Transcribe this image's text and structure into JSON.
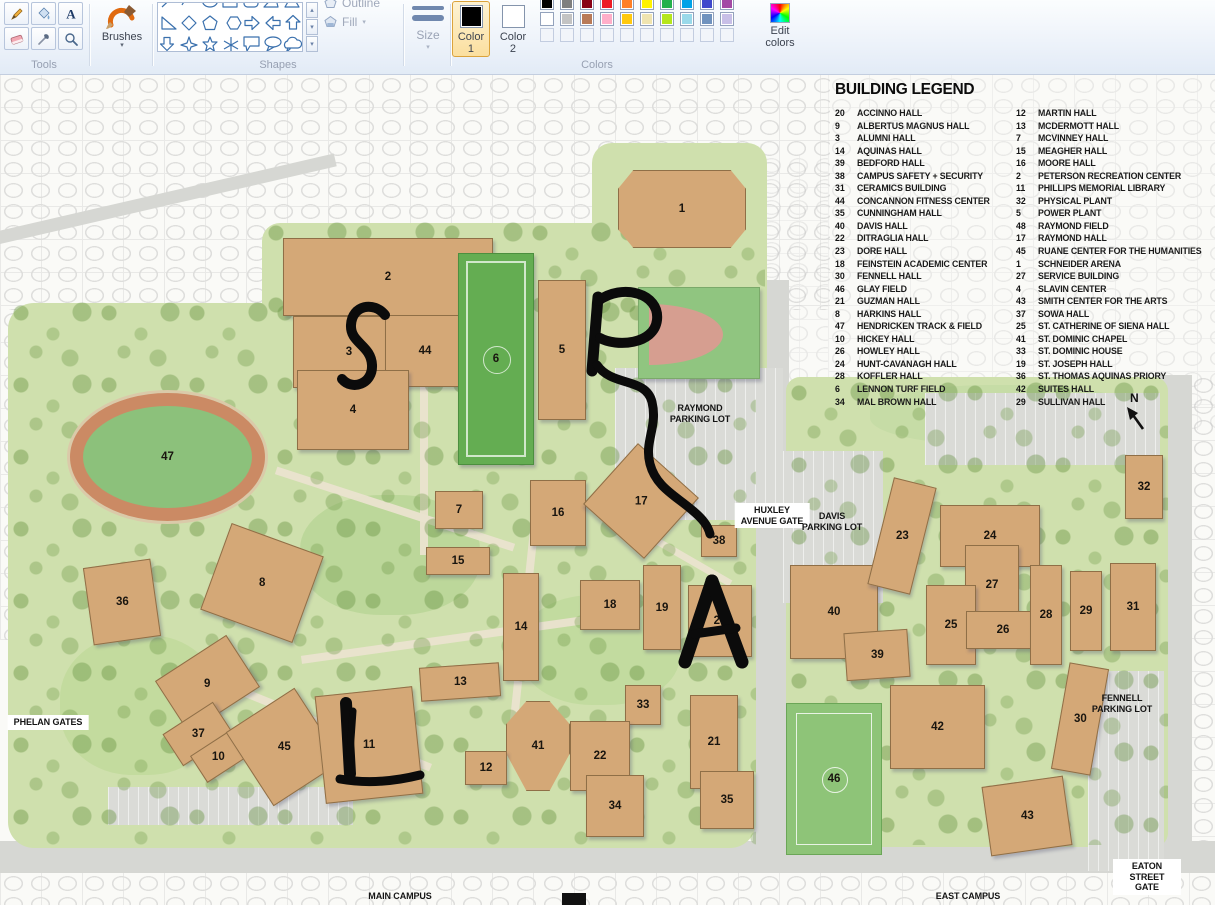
{
  "ribbon": {
    "tools": {
      "label": "Tools",
      "items": [
        "pencil",
        "fill-with-color",
        "text",
        "eraser",
        "color-picker",
        "magnifier"
      ]
    },
    "brushes": {
      "label": "Brushes",
      "arrow": "▾"
    },
    "shapes": {
      "label": "Shapes",
      "outline_label": "Outline",
      "fill_label": "Fill",
      "fill_arrow": "▾"
    },
    "size": {
      "label": "Size",
      "arrow": "▾"
    },
    "colors": {
      "label": "Colors",
      "color1": {
        "label_1": "Color",
        "label_2": "1",
        "value": "#000000"
      },
      "color2": {
        "label_1": "Color",
        "label_2": "2",
        "value": "#ffffff"
      },
      "edit": {
        "label_1": "Edit",
        "label_2": "colors"
      },
      "palette_row1": [
        "#000000",
        "#7f7f7f",
        "#880015",
        "#ed1c24",
        "#ff7f27",
        "#fff200",
        "#22b14c",
        "#00a2e8",
        "#3f48cc",
        "#a349a4"
      ],
      "palette_row2": [
        "#ffffff",
        "#c3c3c3",
        "#b97a57",
        "#ffaec9",
        "#ffc90e",
        "#efe4b0",
        "#b5e61d",
        "#99d9ea",
        "#7092be",
        "#c8bfe7"
      ],
      "palette_row3": [
        "",
        "",
        "",
        "",
        "",
        "",
        "",
        "",
        "",
        ""
      ]
    }
  },
  "map": {
    "legend": {
      "title": "BUILDING LEGEND",
      "left": [
        {
          "n": "20",
          "name": "ACCINNO HALL"
        },
        {
          "n": "9",
          "name": "ALBERTUS MAGNUS HALL"
        },
        {
          "n": "3",
          "name": "ALUMNI HALL"
        },
        {
          "n": "14",
          "name": "AQUINAS HALL"
        },
        {
          "n": "39",
          "name": "BEDFORD HALL"
        },
        {
          "n": "38",
          "name": "CAMPUS SAFETY + SECURITY"
        },
        {
          "n": "31",
          "name": "CERAMICS BUILDING"
        },
        {
          "n": "44",
          "name": "CONCANNON FITNESS CENTER"
        },
        {
          "n": "35",
          "name": "CUNNINGHAM HALL"
        },
        {
          "n": "40",
          "name": "DAVIS HALL"
        },
        {
          "n": "22",
          "name": "DITRAGLIA HALL"
        },
        {
          "n": "23",
          "name": "DORE HALL"
        },
        {
          "n": "18",
          "name": "FEINSTEIN ACADEMIC CENTER"
        },
        {
          "n": "30",
          "name": "FENNELL HALL"
        },
        {
          "n": "46",
          "name": "GLAY FIELD"
        },
        {
          "n": "21",
          "name": "GUZMAN HALL"
        },
        {
          "n": "8",
          "name": "HARKINS HALL"
        },
        {
          "n": "47",
          "name": "HENDRICKEN TRACK & FIELD"
        },
        {
          "n": "10",
          "name": "HICKEY HALL"
        },
        {
          "n": "26",
          "name": "HOWLEY HALL"
        },
        {
          "n": "24",
          "name": "HUNT-CAVANAGH HALL"
        },
        {
          "n": "28",
          "name": "KOFFLER HALL"
        },
        {
          "n": "6",
          "name": "LENNON TURF FIELD"
        },
        {
          "n": "34",
          "name": "MAL BROWN HALL"
        }
      ],
      "right": [
        {
          "n": "12",
          "name": "MARTIN HALL"
        },
        {
          "n": "13",
          "name": "MCDERMOTT HALL"
        },
        {
          "n": "7",
          "name": "MCVINNEY HALL"
        },
        {
          "n": "15",
          "name": "MEAGHER HALL"
        },
        {
          "n": "16",
          "name": "MOORE HALL"
        },
        {
          "n": "2",
          "name": "PETERSON RECREATION CENTER"
        },
        {
          "n": "11",
          "name": "PHILLIPS MEMORIAL LIBRARY"
        },
        {
          "n": "32",
          "name": "PHYSICAL PLANT"
        },
        {
          "n": "5",
          "name": "POWER PLANT"
        },
        {
          "n": "48",
          "name": "RAYMOND FIELD"
        },
        {
          "n": "17",
          "name": "RAYMOND HALL"
        },
        {
          "n": "45",
          "name": "RUANE CENTER FOR THE HUMANITIES"
        },
        {
          "n": "1",
          "name": "SCHNEIDER ARENA"
        },
        {
          "n": "27",
          "name": "SERVICE BUILDING"
        },
        {
          "n": "4",
          "name": "SLAVIN CENTER"
        },
        {
          "n": "43",
          "name": "SMITH CENTER FOR THE ARTS"
        },
        {
          "n": "37",
          "name": "SOWA HALL"
        },
        {
          "n": "25",
          "name": "ST. CATHERINE OF SIENA HALL"
        },
        {
          "n": "41",
          "name": "ST. DOMINIC CHAPEL"
        },
        {
          "n": "33",
          "name": "ST. DOMINIC HOUSE"
        },
        {
          "n": "19",
          "name": "ST. JOSEPH HALL"
        },
        {
          "n": "36",
          "name": "ST. THOMAS AQUINAS PRIORY"
        },
        {
          "n": "42",
          "name": "SUITES HALL"
        },
        {
          "n": "29",
          "name": "SULLIVAN HALL"
        }
      ]
    },
    "labels": [
      {
        "text": "RAYMOND\nPARKING LOT",
        "x": 700,
        "y": 328
      },
      {
        "text": "HUXLEY\nAVENUE GATE",
        "x": 772,
        "y": 428,
        "boxed": true
      },
      {
        "text": "DAVIS\nPARKING LOT",
        "x": 832,
        "y": 436
      },
      {
        "text": "PHELAN GATES",
        "x": 48,
        "y": 640,
        "boxed": true
      },
      {
        "text": "FENNELL\nPARKING LOT",
        "x": 1122,
        "y": 618
      },
      {
        "text": "EATON STREET GATE",
        "x": 1147,
        "y": 784,
        "boxed": true
      },
      {
        "text": "MAIN CAMPUS",
        "x": 400,
        "y": 816
      },
      {
        "text": "EAST CAMPUS",
        "x": 968,
        "y": 816
      }
    ],
    "compass_n": "N",
    "buildings": [
      {
        "num": "1",
        "x": 618,
        "y": 95,
        "w": 128,
        "h": 78,
        "type": "arena"
      },
      {
        "num": "2",
        "x": 283,
        "y": 163,
        "w": 210,
        "h": 78
      },
      {
        "num": "3",
        "x": 293,
        "y": 241,
        "w": 112,
        "h": 72
      },
      {
        "num": "44",
        "x": 385,
        "y": 240,
        "w": 80,
        "h": 72
      },
      {
        "num": "4",
        "x": 297,
        "y": 295,
        "w": 112,
        "h": 80
      },
      {
        "num": "5",
        "x": 538,
        "y": 205,
        "w": 48,
        "h": 140
      },
      {
        "num": "6",
        "x": 458,
        "y": 178,
        "w": 76,
        "h": 212,
        "type": "turf"
      },
      {
        "num": "48",
        "x": 638,
        "y": 212,
        "w": 122,
        "h": 92,
        "type": "ball"
      },
      {
        "num": "47",
        "x": 70,
        "y": 318,
        "w": 195,
        "h": 128,
        "type": "track"
      },
      {
        "num": "36",
        "x": 88,
        "y": 488,
        "w": 68,
        "h": 78,
        "rot": -8
      },
      {
        "num": "8",
        "x": 213,
        "y": 462,
        "w": 98,
        "h": 92,
        "rot": 20
      },
      {
        "num": "7",
        "x": 435,
        "y": 416,
        "w": 48,
        "h": 38
      },
      {
        "num": "16",
        "x": 530,
        "y": 405,
        "w": 56,
        "h": 66
      },
      {
        "num": "17",
        "x": 600,
        "y": 385,
        "w": 82,
        "h": 82,
        "rot": 42
      },
      {
        "num": "38",
        "x": 701,
        "y": 450,
        "w": 36,
        "h": 32
      },
      {
        "num": "15",
        "x": 426,
        "y": 472,
        "w": 64,
        "h": 28
      },
      {
        "num": "14",
        "x": 503,
        "y": 498,
        "w": 36,
        "h": 108
      },
      {
        "num": "18",
        "x": 580,
        "y": 505,
        "w": 60,
        "h": 50
      },
      {
        "num": "19",
        "x": 643,
        "y": 490,
        "w": 38,
        "h": 85
      },
      {
        "num": "20",
        "x": 688,
        "y": 510,
        "w": 64,
        "h": 72
      },
      {
        "num": "13",
        "x": 420,
        "y": 590,
        "w": 80,
        "h": 34,
        "rot": -4
      },
      {
        "num": "33",
        "x": 625,
        "y": 610,
        "w": 36,
        "h": 40
      },
      {
        "num": "9",
        "x": 165,
        "y": 578,
        "w": 85,
        "h": 62,
        "rot": -33
      },
      {
        "num": "37",
        "x": 168,
        "y": 640,
        "w": 60,
        "h": 38,
        "rot": -33
      },
      {
        "num": "10",
        "x": 195,
        "y": 666,
        "w": 46,
        "h": 32,
        "rot": -33
      },
      {
        "num": "45",
        "x": 243,
        "y": 628,
        "w": 82,
        "h": 88,
        "rot": -33
      },
      {
        "num": "11",
        "x": 320,
        "y": 616,
        "w": 98,
        "h": 108,
        "rot": -6
      },
      {
        "num": "41",
        "x": 506,
        "y": 626,
        "w": 64,
        "h": 90,
        "type": "chapel"
      },
      {
        "num": "12",
        "x": 465,
        "y": 676,
        "w": 42,
        "h": 34
      },
      {
        "num": "22",
        "x": 570,
        "y": 646,
        "w": 60,
        "h": 70
      },
      {
        "num": "21",
        "x": 690,
        "y": 620,
        "w": 48,
        "h": 94
      },
      {
        "num": "34",
        "x": 586,
        "y": 700,
        "w": 58,
        "h": 62
      },
      {
        "num": "35",
        "x": 700,
        "y": 696,
        "w": 54,
        "h": 58
      },
      {
        "num": "40",
        "x": 790,
        "y": 490,
        "w": 88,
        "h": 94
      },
      {
        "num": "23",
        "x": 880,
        "y": 406,
        "w": 44,
        "h": 110,
        "rot": 14
      },
      {
        "num": "24",
        "x": 940,
        "y": 430,
        "w": 100,
        "h": 62
      },
      {
        "num": "27",
        "x": 965,
        "y": 470,
        "w": 54,
        "h": 80
      },
      {
        "num": "25",
        "x": 926,
        "y": 510,
        "w": 50,
        "h": 80
      },
      {
        "num": "26",
        "x": 966,
        "y": 536,
        "w": 74,
        "h": 38
      },
      {
        "num": "28",
        "x": 1030,
        "y": 490,
        "w": 32,
        "h": 100
      },
      {
        "num": "29",
        "x": 1070,
        "y": 496,
        "w": 32,
        "h": 80
      },
      {
        "num": "31",
        "x": 1110,
        "y": 488,
        "w": 46,
        "h": 88
      },
      {
        "num": "32",
        "x": 1125,
        "y": 380,
        "w": 38,
        "h": 64
      },
      {
        "num": "39",
        "x": 845,
        "y": 556,
        "w": 64,
        "h": 48,
        "rot": -4
      },
      {
        "num": "42",
        "x": 890,
        "y": 610,
        "w": 95,
        "h": 84
      },
      {
        "num": "46",
        "x": 786,
        "y": 628,
        "w": 96,
        "h": 152,
        "type": "soccer"
      },
      {
        "num": "43",
        "x": 986,
        "y": 706,
        "w": 82,
        "h": 70,
        "rot": -8
      },
      {
        "num": "30",
        "x": 1060,
        "y": 590,
        "w": 40,
        "h": 108,
        "rot": 10
      }
    ]
  }
}
